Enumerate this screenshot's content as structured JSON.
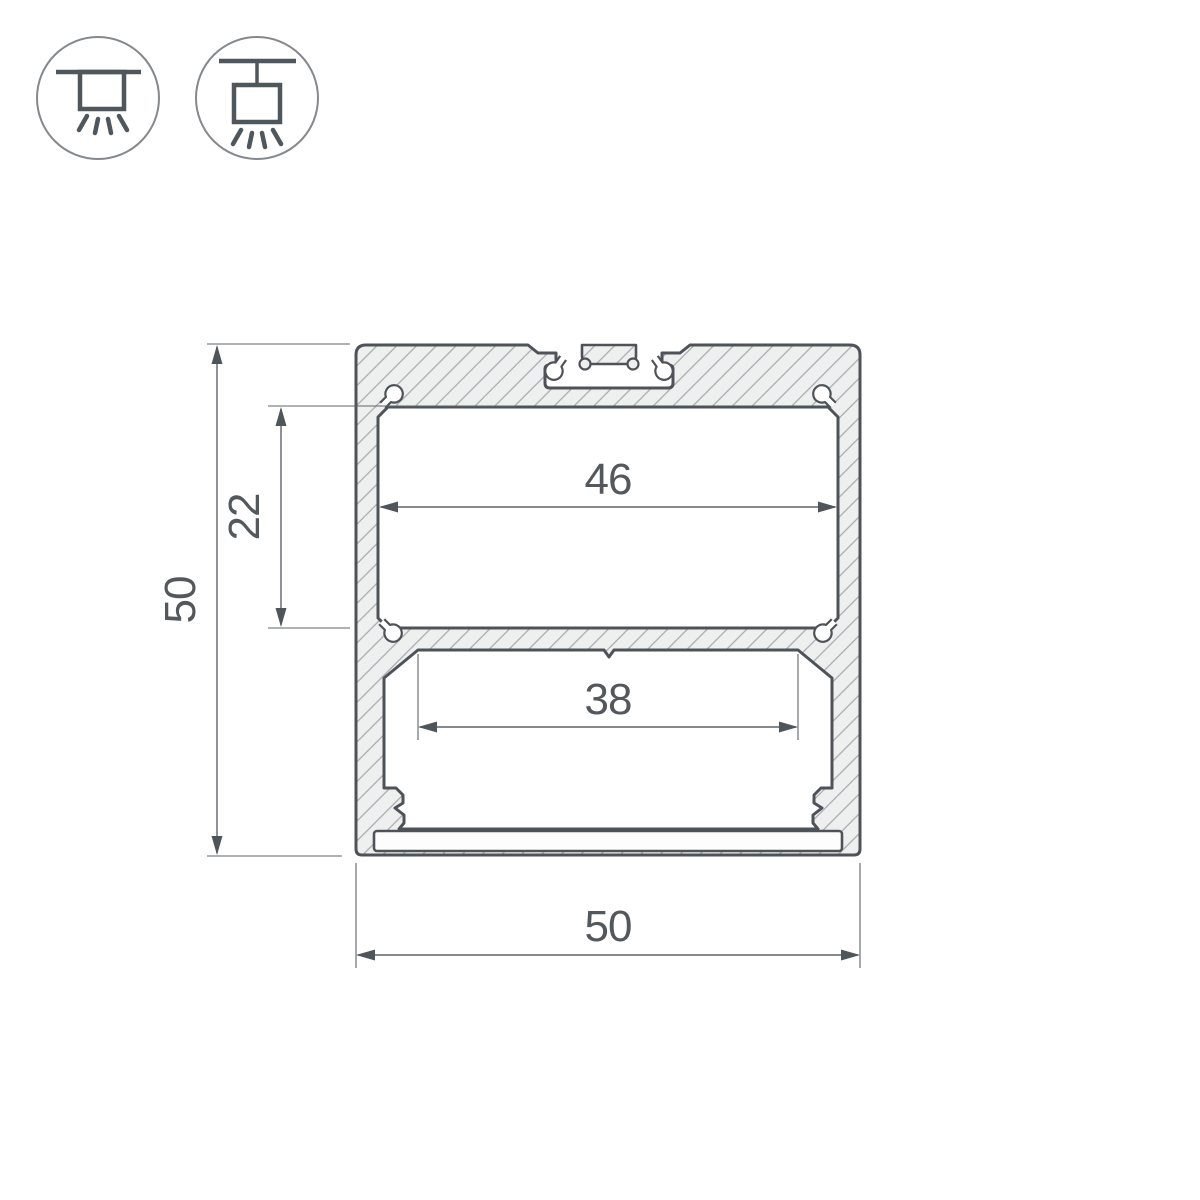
{
  "drawing": {
    "type": "technical-cross-section",
    "subject": "aluminum LED profile cross-section with dimensions",
    "dimensions": {
      "total_height": "50",
      "upper_chamber_height": "22",
      "upper_chamber_width": "46",
      "lower_chamber_width": "38",
      "total_width": "50"
    },
    "icons": [
      {
        "name": "surface-mount-icon",
        "meaning": "ceiling surface mounting with light emitted downward"
      },
      {
        "name": "suspended-mount-icon",
        "meaning": "suspended (pendant) mounting with light emitted downward"
      }
    ],
    "colors": {
      "background": "#ffffff",
      "outline": "#4d5358",
      "material_fill": "#eef0f0",
      "hatch_line": "#a6abaf",
      "dimension_line": "#5f646a",
      "dimension_text": "#53585d",
      "icon_circle": "#85898d",
      "icon_glyph": "#4f565c"
    }
  }
}
